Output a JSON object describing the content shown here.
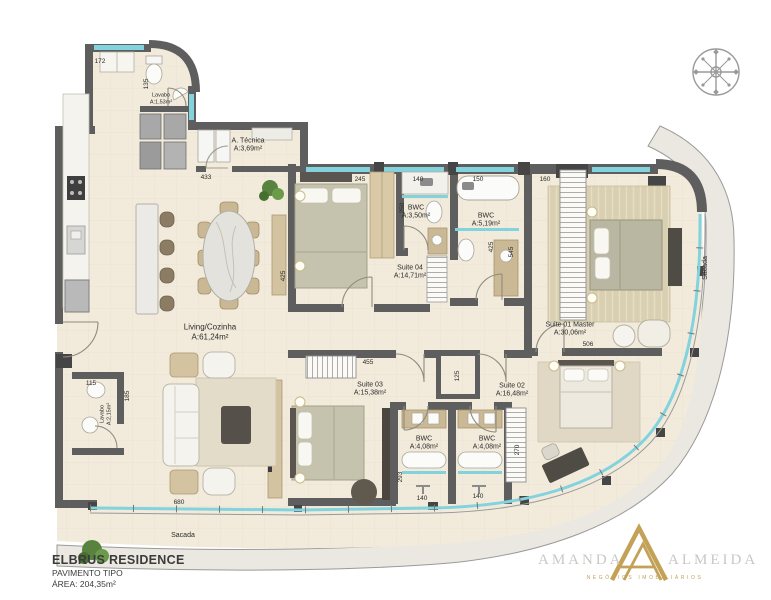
{
  "plan": {
    "rooms": {
      "lavabo_top": {
        "name": "Lavabo",
        "area": "A:1,53m²"
      },
      "a_tecnica": {
        "name": "A. Técnica",
        "area": "A:3,69m²"
      },
      "living": {
        "name": "Living/Cozinha",
        "area": "A:61,24m²"
      },
      "suite04": {
        "name": "Suite 04",
        "area": "A:14,71m²"
      },
      "bwc_suite04": {
        "name": "BWC",
        "area": "A:3,50m²"
      },
      "bwc_social": {
        "name": "BWC",
        "area": "A:5,19m²"
      },
      "suite01": {
        "name": "Suite 01 Master",
        "area": "A:30,06m²"
      },
      "suite03": {
        "name": "Suite 03",
        "area": "A:15,38m²"
      },
      "suite02": {
        "name": "Suite 02",
        "area": "A:16,48m²"
      },
      "bwc_suite03": {
        "name": "BWC",
        "area": "A:4,08m²"
      },
      "bwc_suite02": {
        "name": "BWC",
        "area": "A:4,08m²"
      },
      "lavabo_bottom": {
        "name": "Lavabo",
        "area": "A:2,15m²"
      },
      "sacada_bottom": {
        "name": "Sacada"
      },
      "sacada_right": {
        "name": "Sacada"
      }
    },
    "dimensions": {
      "d172": "172",
      "d135": "135",
      "d433": "433",
      "d245": "245",
      "d140a": "140",
      "d150": "150",
      "d160": "160",
      "d250": "250",
      "d425a": "425",
      "d545": "545",
      "d425b": "425",
      "d506": "506",
      "d455": "455",
      "d125": "125",
      "d115": "115",
      "d185": "185",
      "d680": "680",
      "d293": "293",
      "d140b": "140",
      "d140c": "140",
      "d270": "270"
    }
  },
  "title_block": {
    "project": "ELBRUS RESIDENCE",
    "floor": "PAVIMENTO TIPO",
    "area": "ÁREA: 204,35m²"
  },
  "logo": {
    "first_name": "AMANDA",
    "last_name": "ALMEIDA",
    "tagline": "NEGÓCIOS IMOBILIÁRIOS"
  },
  "colors": {
    "floor": "#f2ebdc",
    "wall": "#5e5e5e",
    "glass": "#82d3de",
    "band": "#ebe8e1",
    "gold": "#c3a257"
  }
}
